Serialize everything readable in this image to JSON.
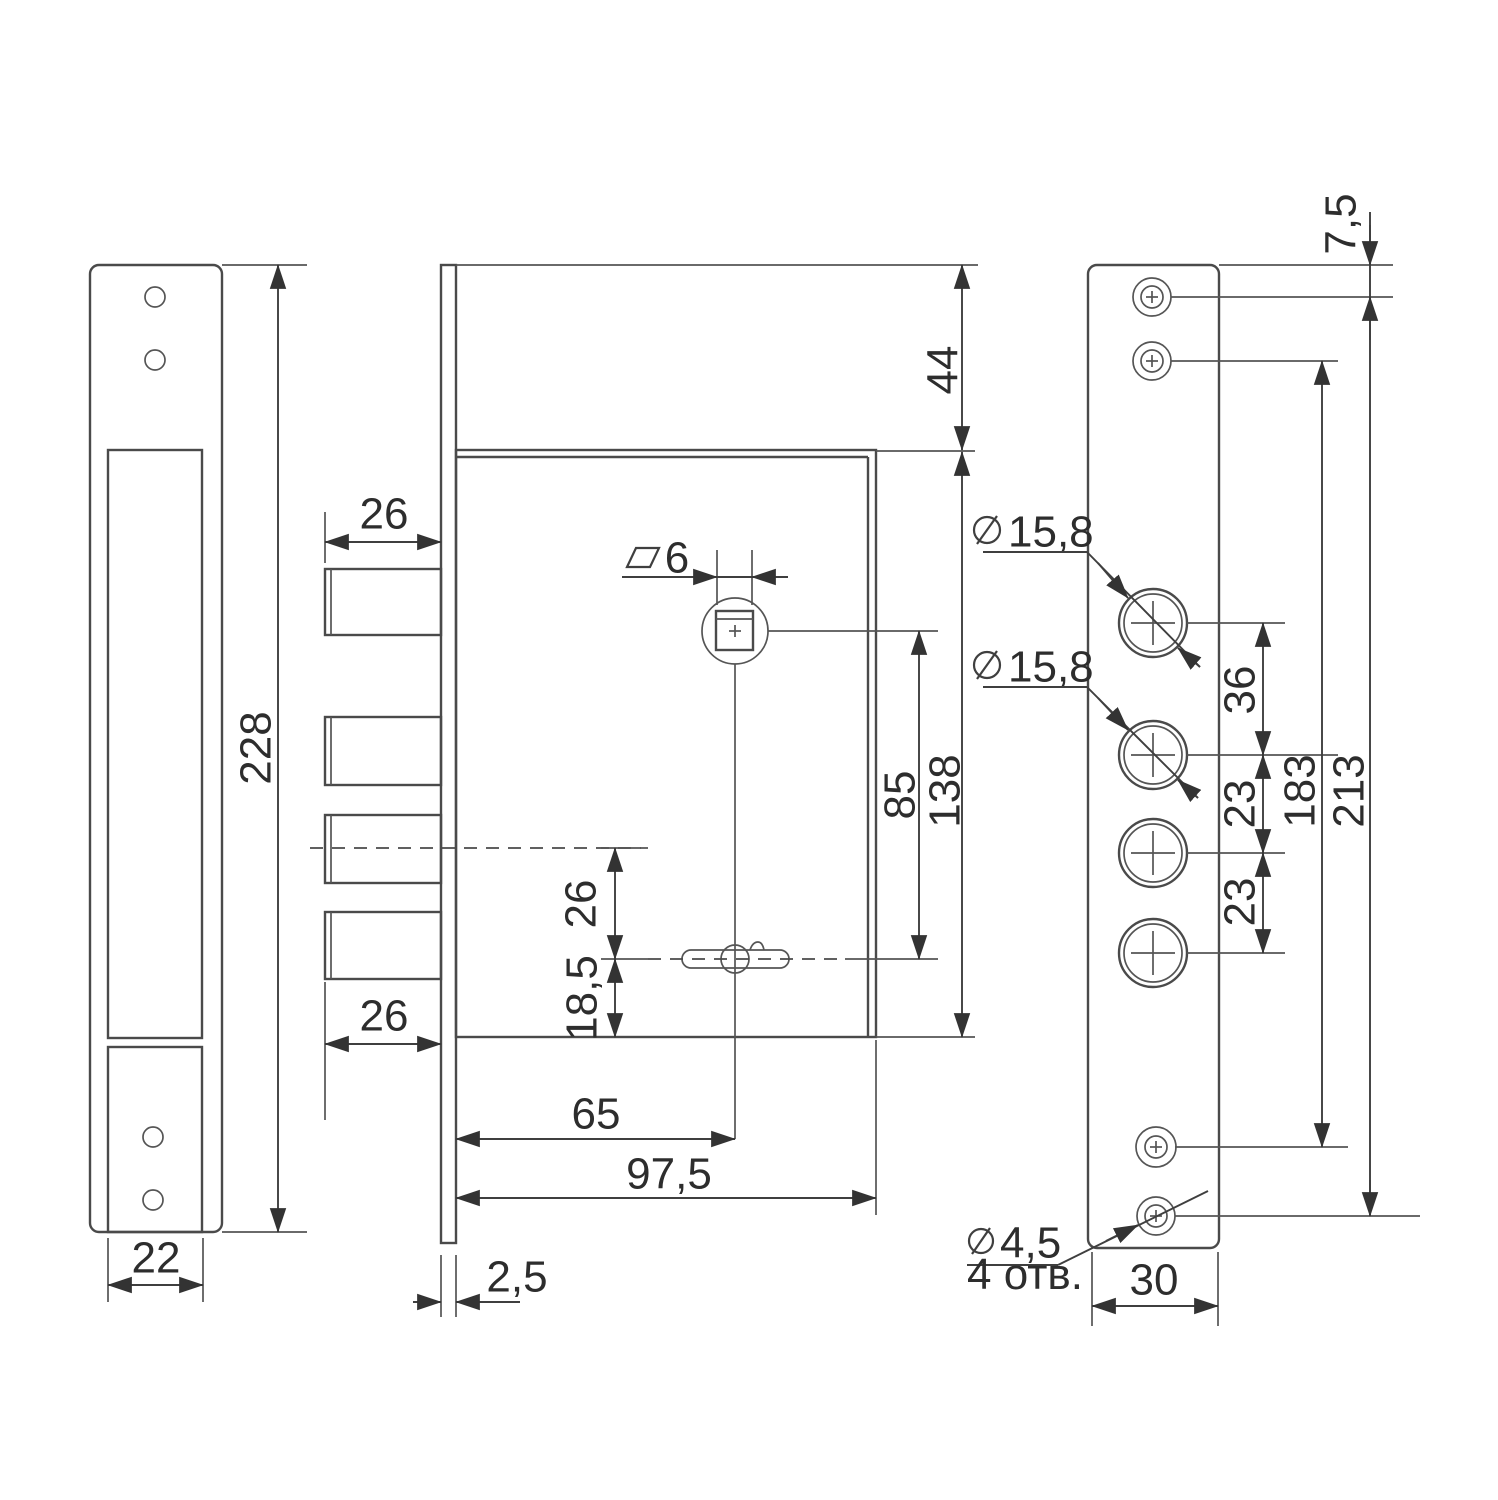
{
  "title": "Mortise lock dimensional drawing",
  "colors": {
    "line": "#4a4a4a",
    "dimension": "#3f3f3f",
    "text": "#2d2d2d",
    "background": "#ffffff"
  },
  "views": {
    "strike_plate": {
      "height": "228",
      "width": "22"
    },
    "lock_body": {
      "bolt_width_top": "26",
      "bolt_width_bottom": "26",
      "square_spindle": "6",
      "face_offset": "44",
      "body_height": "138",
      "spindle_to_keyhole": "85",
      "center_to_keyhole": "26",
      "keyhole_to_bottom": "18,5",
      "backset": "65",
      "body_depth": "97,5",
      "faceplate_thickness": "2,5"
    },
    "front_plate": {
      "top_screw_offset": "7,5",
      "cylinder_dia_1": "15,8",
      "cylinder_dia_2": "15,8",
      "hole_gap_top": "36",
      "hole_gap_mid": "23",
      "hole_gap_bottom": "23",
      "screw_span": "183",
      "total_span": "213",
      "screw_dia": "4,5",
      "screw_count": "4 отв.",
      "width": "30"
    }
  }
}
